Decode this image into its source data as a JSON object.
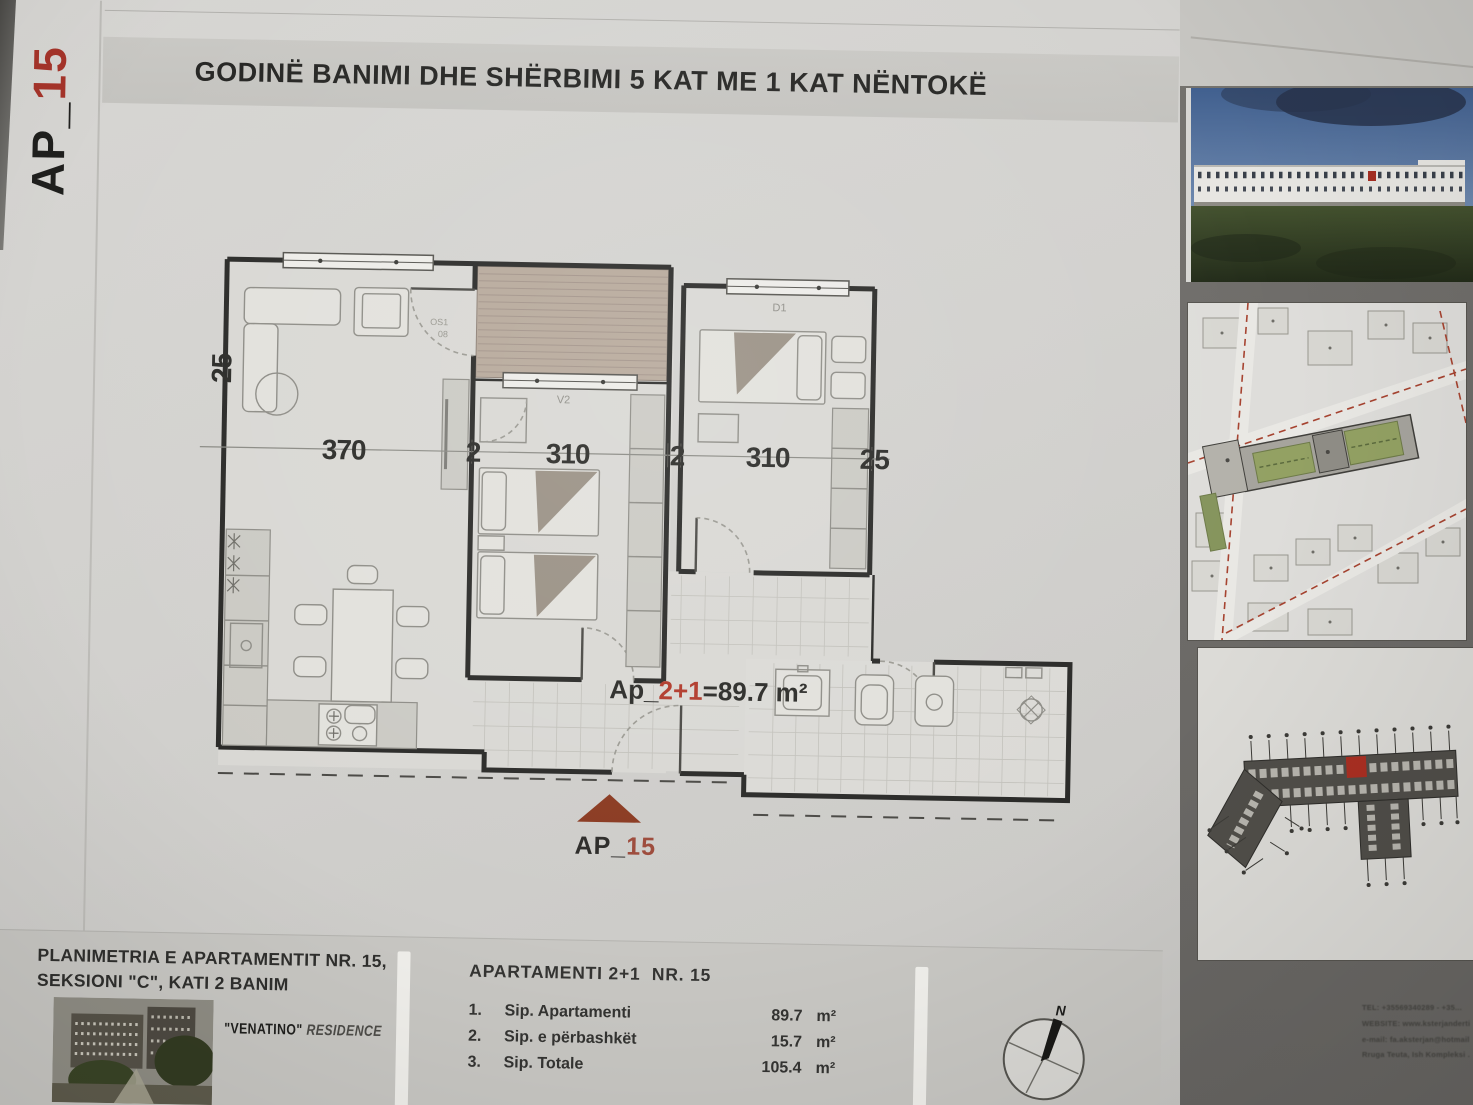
{
  "sheet": {
    "title": "GODINË BANIMI DHE SHËRBIMI 5 KAT ME 1 KAT NËNTOKË",
    "corner_label": {
      "prefix": "AP_",
      "number": "15"
    }
  },
  "plan": {
    "dimensions": {
      "wall_left": "25",
      "living": "370",
      "wall_a": "2",
      "bedroom1": "310",
      "wall_b": "2",
      "bedroom2": "310",
      "wall_right": "25"
    },
    "tags": {
      "window_mid": "V2",
      "door_right": "D1",
      "door_terrace_1": "OS1",
      "door_terrace_2": "08"
    },
    "area_label": {
      "prefix": "Ap_",
      "rooms": "2+1",
      "suffix": "=89.7 m²"
    },
    "marker_label": {
      "prefix": "AP_",
      "number": "15"
    }
  },
  "title_block": {
    "plan_caption_line1": "PLANIMETRIA E APARTAMENTIT NR. 15,",
    "plan_caption_line2": "SEKSIONI \"C\", KATI 2 BANIM",
    "residence_name": "\"VENATINO\"",
    "residence_suffix": " RESIDENCE",
    "apartment_heading": "APARTAMENTI 2+1  NR. 15",
    "area_rows": [
      {
        "no": "1.",
        "label": "Sip. Apartamenti",
        "value": "89.7",
        "unit": "m²"
      },
      {
        "no": "2.",
        "label": "Sip. e përbashkët",
        "value": "15.7",
        "unit": "m²"
      },
      {
        "no": "3.",
        "label": "Sip. Totale",
        "value": "105.4",
        "unit": "m²"
      }
    ],
    "compass_north": "N"
  },
  "contact": {
    "line1": "TEL: +35569340289 - +35...",
    "line2": "WEBSITE: www.ksterjanderti...",
    "line3": "e-mail: fa.aksterjan@hotmail...",
    "line4": "Rruga Teuta, Ish Kompleksi ..."
  },
  "colors": {
    "accent_red": "#a93a2a",
    "marker_brown": "#8a3a21",
    "terrace_fill": "#b7a99b"
  }
}
